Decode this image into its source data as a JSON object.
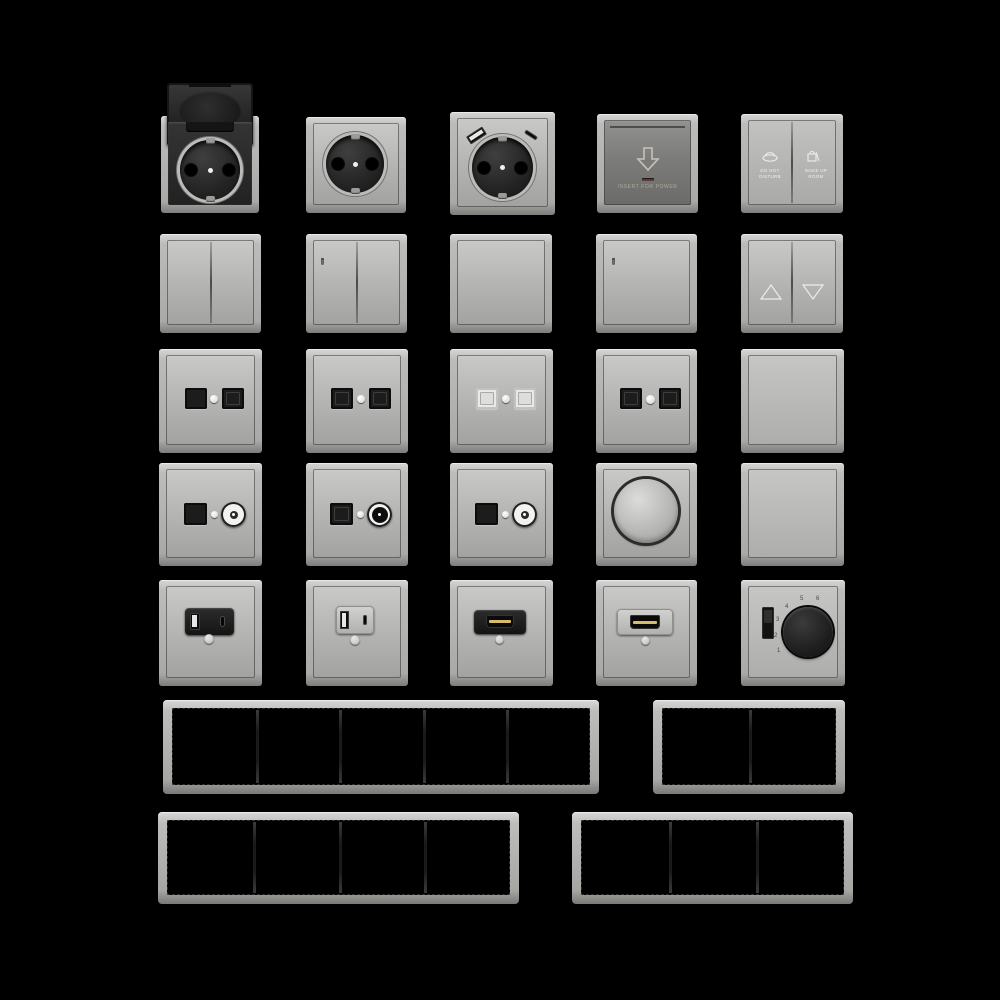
{
  "scene": {
    "description": "Product render sheet of a gray modular electrical switch series on black background",
    "background": "#000000",
    "colors": {
      "plate_light": "#c9cac8",
      "plate_mid": "#aaaba8",
      "plate_edge_dark": "#7c7d7a",
      "card_plate": "#7c7d7b",
      "insert_black": "#1c1c1c",
      "port_white": "#e9eae8",
      "hdmi_gold": "#d8bc6b",
      "led_dark_red": "#5d403a",
      "icon_light": "#eceded"
    }
  },
  "card_switch": {
    "text": "INSERT FOR POWER",
    "icon": "arrow-down-outline-icon"
  },
  "dnd_switch": {
    "left_label": "Do not disturb",
    "right_label": "Make up room",
    "left_icon": "do-not-disturb-icon",
    "right_icon": "make-up-room-icon"
  },
  "shutter_switch": {
    "up_icon": "triangle-up-outline-icon",
    "down_icon": "triangle-down-outline-icon"
  },
  "thermostat": {
    "scale": [
      "1",
      "2",
      "3",
      "4",
      "5",
      "6"
    ],
    "parts": [
      "rotary-knob",
      "on-off-slider"
    ]
  },
  "items": [
    {
      "row": 1,
      "col": 1,
      "name": "schuko-socket-with-hinged-lid-open"
    },
    {
      "row": 1,
      "col": 2,
      "name": "schuko-socket"
    },
    {
      "row": 1,
      "col": 3,
      "name": "schuko-socket-with-usb-a-and-usb-c"
    },
    {
      "row": 1,
      "col": 4,
      "name": "hotel-key-card-power-switch"
    },
    {
      "row": 1,
      "col": 5,
      "name": "do-not-disturb-make-up-room-switch"
    },
    {
      "row": 2,
      "col": 1,
      "name": "double-rocker-switch"
    },
    {
      "row": 2,
      "col": 2,
      "name": "double-rocker-switch-with-led"
    },
    {
      "row": 2,
      "col": 3,
      "name": "single-rocker-switch"
    },
    {
      "row": 2,
      "col": 4,
      "name": "single-rocker-switch-with-led"
    },
    {
      "row": 2,
      "col": 5,
      "name": "shutter-rocker-switch-up-down"
    },
    {
      "row": 3,
      "col": 1,
      "name": "dual-data-outlet-black"
    },
    {
      "row": 3,
      "col": 2,
      "name": "dual-data-outlet-black"
    },
    {
      "row": 3,
      "col": 3,
      "name": "dual-data-outlet-white"
    },
    {
      "row": 3,
      "col": 4,
      "name": "dual-data-outlet-black"
    },
    {
      "row": 3,
      "col": 5,
      "name": "blank-rocker-plate"
    },
    {
      "row": 4,
      "col": 1,
      "name": "data-plus-coax-outlet"
    },
    {
      "row": 4,
      "col": 2,
      "name": "data-plus-coax-outlet-dark-center"
    },
    {
      "row": 4,
      "col": 3,
      "name": "data-plus-coax-outlet"
    },
    {
      "row": 4,
      "col": 4,
      "name": "rotary-dimmer"
    },
    {
      "row": 4,
      "col": 5,
      "name": "blank-cover-plate"
    },
    {
      "row": 5,
      "col": 1,
      "name": "usb-charger-outlet-black"
    },
    {
      "row": 5,
      "col": 2,
      "name": "usb-charger-outlet-light"
    },
    {
      "row": 5,
      "col": 3,
      "name": "hdmi-outlet-black"
    },
    {
      "row": 5,
      "col": 4,
      "name": "hdmi-outlet-light"
    },
    {
      "row": 5,
      "col": 5,
      "name": "thermostat-with-rotary-knob"
    }
  ],
  "frames": [
    {
      "name": "frame-5-gang",
      "gangs": 5
    },
    {
      "name": "frame-2-gang",
      "gangs": 2
    },
    {
      "name": "frame-4-gang",
      "gangs": 4
    },
    {
      "name": "frame-3-gang",
      "gangs": 3
    }
  ]
}
